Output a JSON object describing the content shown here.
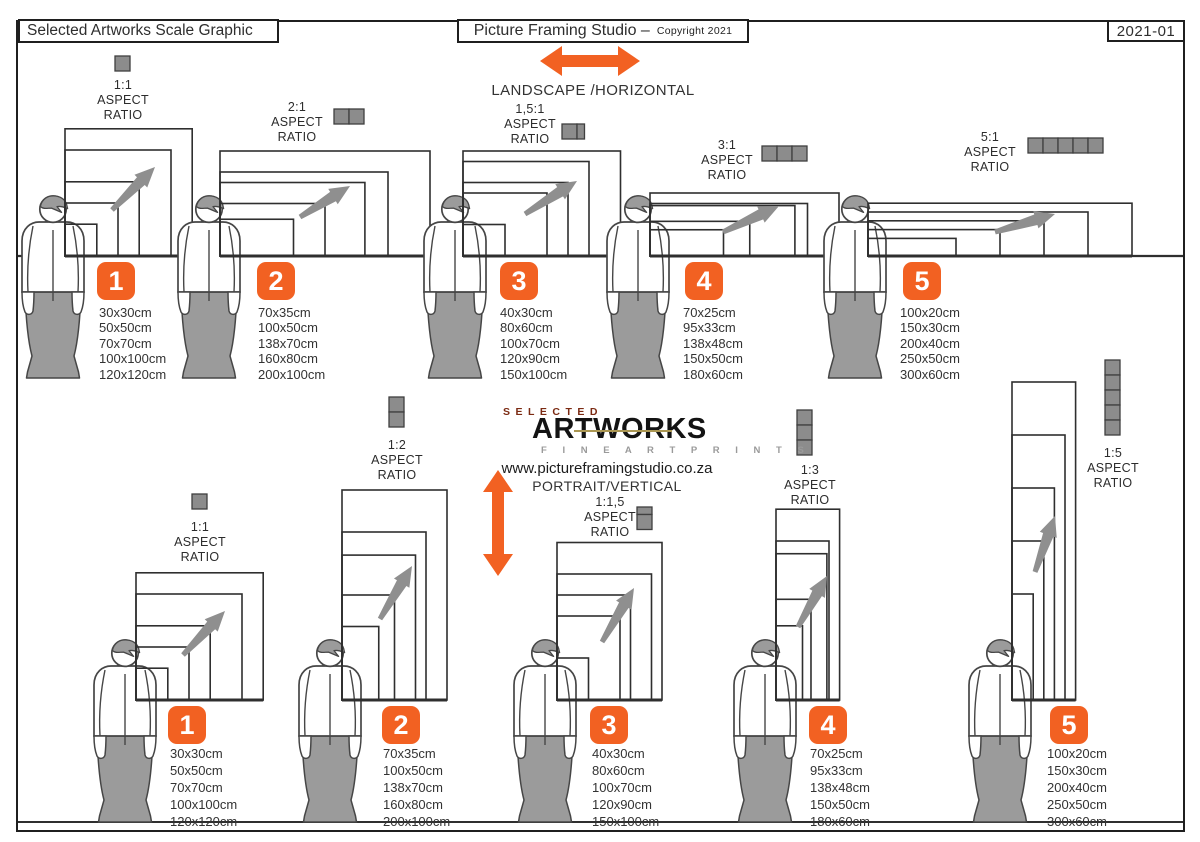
{
  "page": {
    "title_left": "Selected Artworks Scale Graphic",
    "title_center": "Picture Framing Studio –",
    "title_center_small": "Copyright 2021",
    "title_right": "2021-01"
  },
  "orientation_labels": {
    "landscape": "LANDSCAPE /HORIZONTAL",
    "portrait": "PORTRAIT/VERTICAL"
  },
  "logo": {
    "selected": "SELECTED",
    "artworks": "ARTWORKS",
    "tagline": "F I N E   A R T   P R I N T S",
    "website": "www.pictureframingstudio.co.za"
  },
  "aspect_word1": "ASPECT",
  "aspect_word2": "RATIO",
  "colors": {
    "accent": "#F26122",
    "figure_gray": "#9b9b9b",
    "icon_gray": "#8c8c8c",
    "arrow_gray": "#8f8f8f",
    "line_dark": "#2f2f2f"
  },
  "landscape_groups": [
    {
      "number": "1",
      "ratio": "1:1",
      "icon": "1-square-horizontal",
      "icon_units": 1,
      "sizes": [
        "30x30cm",
        "50x50cm",
        "70x70cm",
        "100x100cm",
        "120x120cm"
      ]
    },
    {
      "number": "2",
      "ratio": "2:1",
      "icon": "2-squares-horizontal",
      "icon_units": 2,
      "sizes": [
        "70x35cm",
        "100x50cm",
        "138x70cm",
        "160x80cm",
        "200x100cm"
      ]
    },
    {
      "number": "3",
      "ratio": "1,5:1",
      "icon": "1.5-squares-horizontal",
      "icon_units": 1.5,
      "sizes": [
        "40x30cm",
        "80x60cm",
        "100x70cm",
        "120x90cm",
        "150x100cm"
      ]
    },
    {
      "number": "4",
      "ratio": "3:1",
      "icon": "3-squares-horizontal",
      "icon_units": 3,
      "sizes": [
        "70x25cm",
        "95x33cm",
        "138x48cm",
        "150x50cm",
        "180x60cm"
      ]
    },
    {
      "number": "5",
      "ratio": "5:1",
      "icon": "5-squares-horizontal",
      "icon_units": 5,
      "sizes": [
        "100x20cm",
        "150x30cm",
        "200x40cm",
        "250x50cm",
        "300x60cm"
      ]
    }
  ],
  "portrait_groups": [
    {
      "number": "1",
      "ratio": "1:1",
      "icon": "1-square-vertical",
      "icon_units": 1,
      "sizes": [
        "30x30cm",
        "50x50cm",
        "70x70cm",
        "100x100cm",
        "120x120cm"
      ]
    },
    {
      "number": "2",
      "ratio": "1:2",
      "icon": "2-squares-vertical",
      "icon_units": 2,
      "sizes": [
        "70x35cm",
        "100x50cm",
        "138x70cm",
        "160x80cm",
        "200x100cm"
      ]
    },
    {
      "number": "3",
      "ratio": "1:1,5",
      "icon": "1.5-squares-vertical",
      "icon_units": 1.5,
      "sizes": [
        "40x30cm",
        "80x60cm",
        "100x70cm",
        "120x90cm",
        "150x100cm"
      ]
    },
    {
      "number": "4",
      "ratio": "1:3",
      "icon": "3-squares-vertical",
      "icon_units": 3,
      "sizes": [
        "70x25cm",
        "95x33cm",
        "138x48cm",
        "150x50cm",
        "180x60cm"
      ]
    },
    {
      "number": "5",
      "ratio": "1:5",
      "icon": "5-squares-vertical",
      "icon_units": 5,
      "sizes": [
        "100x20cm",
        "150x30cm",
        "200x40cm",
        "250x50cm",
        "300x60cm"
      ]
    }
  ]
}
